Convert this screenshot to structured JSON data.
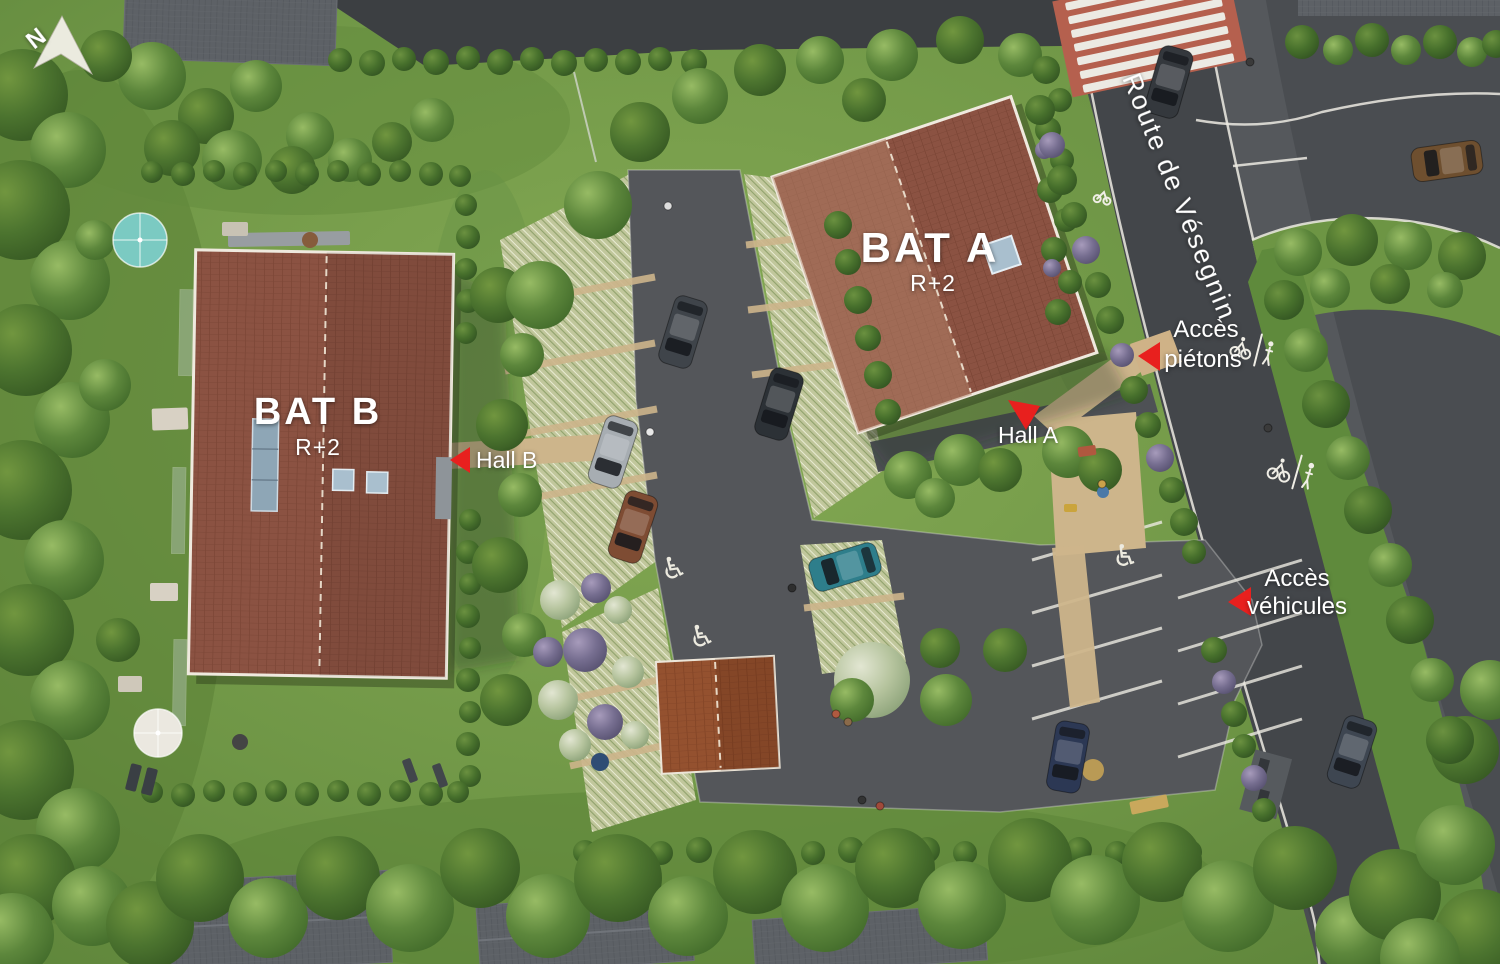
{
  "labels": {
    "north": "N",
    "bat_a": "BAT A",
    "bat_a_level": "R+2",
    "bat_b": "BAT B",
    "bat_b_level": "R+2",
    "hall_a": "Hall A",
    "hall_b": "Hall B",
    "access_ped_1": "Accès",
    "access_ped_2": "piétons",
    "access_veh_1": "Accès",
    "access_veh_2": "véhicules",
    "road_name": "Route de Vésegnin"
  },
  "colors": {
    "accent_red": "#E8201E",
    "roof_tile": "#8B5242",
    "roof_tile_light": "#A87860",
    "grass": "#74984A",
    "paver": "#C1C79C",
    "asphalt_site": "#54565A",
    "asphalt_road": "#46494C",
    "sand": "#CDB58B",
    "marking_white": "#F0EEE7"
  }
}
